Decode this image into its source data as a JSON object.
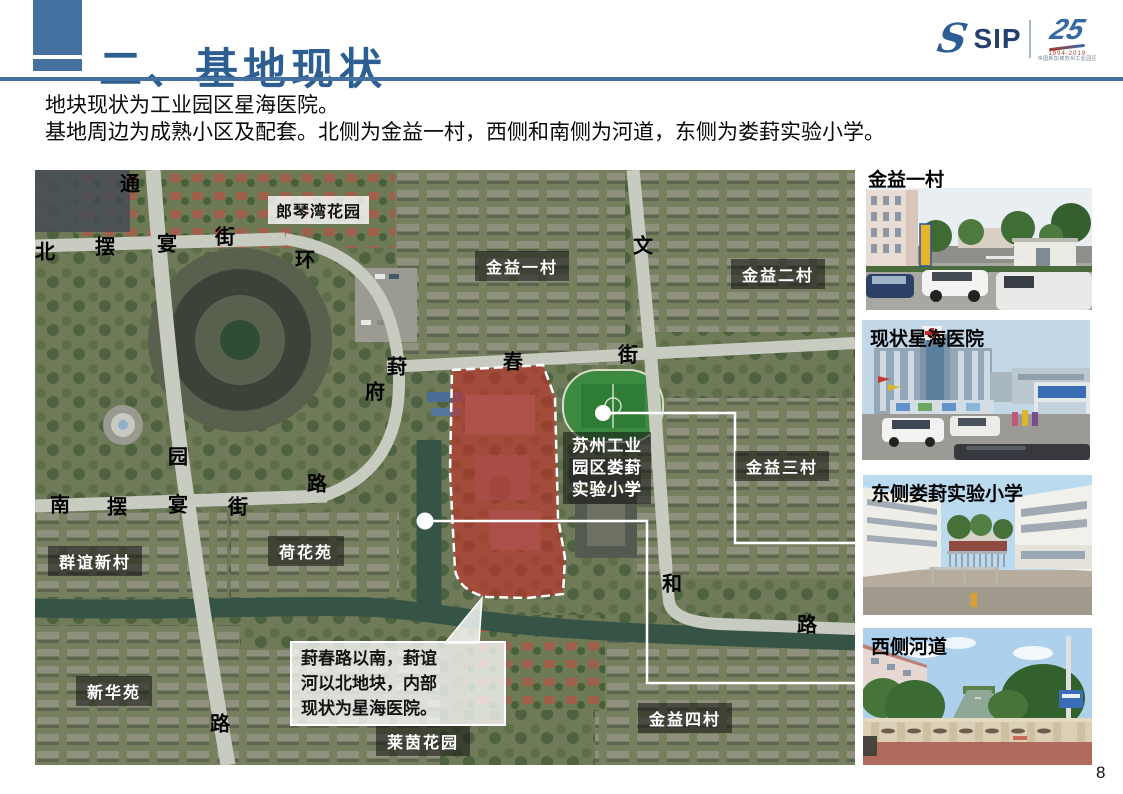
{
  "header": {
    "title": "二、基地现状",
    "logo": {
      "sip": "SIP",
      "anniversary": "25",
      "years": "1994-2019",
      "org": "中国新加坡苏州工业园区"
    }
  },
  "intro": {
    "line1": "地块现状为工业园区星海医院。",
    "line2": "基地周边为成熟小区及配套。北侧为金益一村，西侧和南侧为河道，东侧为娄葑实验小学。"
  },
  "map": {
    "area_labels": [
      {
        "text": "郎琴湾花园"
      },
      {
        "text": "金益一村"
      },
      {
        "text": "金益二村"
      },
      {
        "text": "金益三村"
      },
      {
        "text": "金益四村"
      },
      {
        "text": "荷花苑"
      },
      {
        "text": "群谊新村"
      },
      {
        "text": "新华苑"
      },
      {
        "text": "莱茵花园"
      }
    ],
    "school_label": {
      "line1": "苏州工业",
      "line2": "园区娄葑",
      "line3": "实验小学"
    },
    "road_chars": [
      "通",
      "北",
      "摆",
      "宴",
      "街",
      "环",
      "葑",
      "府",
      "园",
      "路",
      "南",
      "摆",
      "宴",
      "街",
      "路",
      "文",
      "春",
      "街",
      "和",
      "路"
    ],
    "callout": {
      "line1": "葑春路以南，葑谊",
      "line2": "河以北地块，内部",
      "line3": "现状为星海医院。"
    }
  },
  "photos": [
    {
      "label": "金益一村"
    },
    {
      "label": "现状星海医院"
    },
    {
      "label": "东侧娄葑实验小学"
    },
    {
      "label": "西侧河道"
    }
  ],
  "page_number": "8"
}
